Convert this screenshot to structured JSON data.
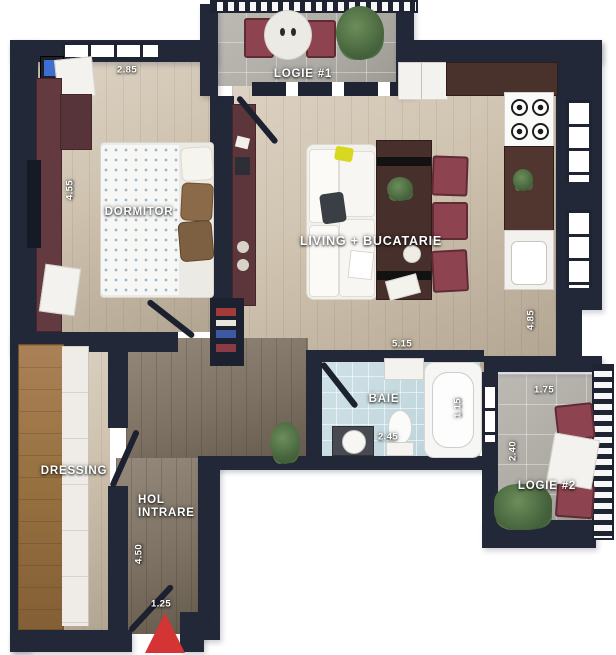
{
  "plan_title": "Apartment floor plan",
  "rooms": {
    "logie1": {
      "label": "LOGIE #1"
    },
    "dormitor": {
      "label": "DORMITOR"
    },
    "living": {
      "label": "LIVING + BUCATARIE"
    },
    "baie": {
      "label": "BAIE"
    },
    "logie2": {
      "label": "LOGIE #2"
    },
    "dressing": {
      "label": "DRESSING"
    },
    "hol": {
      "label_line1": "HOL",
      "label_line2": "INTRARE"
    }
  },
  "dimensions": {
    "dormitor_width": "2.85",
    "dormitor_length": "4.55",
    "living_width": "5.15",
    "living_length": "4.85",
    "baie_width": "2.45",
    "baie_tub_width": "1.15",
    "logie2_width": "1.75",
    "logie2_length": "2.40",
    "hol_length": "4.50",
    "entrance_width": "1.25"
  },
  "markers": {
    "entrance": "red-triangle"
  },
  "colors": {
    "wall": "#232838",
    "floor_light_wood": "#cfc3b0",
    "floor_dark_wood": "#7d7264",
    "bath_tile": "#c2d8de",
    "balcony_concrete": "#aeaba5",
    "furniture_maroon": "#643a41",
    "chair_red": "#8d4450",
    "table_walnut": "#47302b",
    "wardrobe_wood": "#96703f",
    "entrance_marker": "#d43434",
    "accent_pillow_yellow": "#d8d820"
  }
}
